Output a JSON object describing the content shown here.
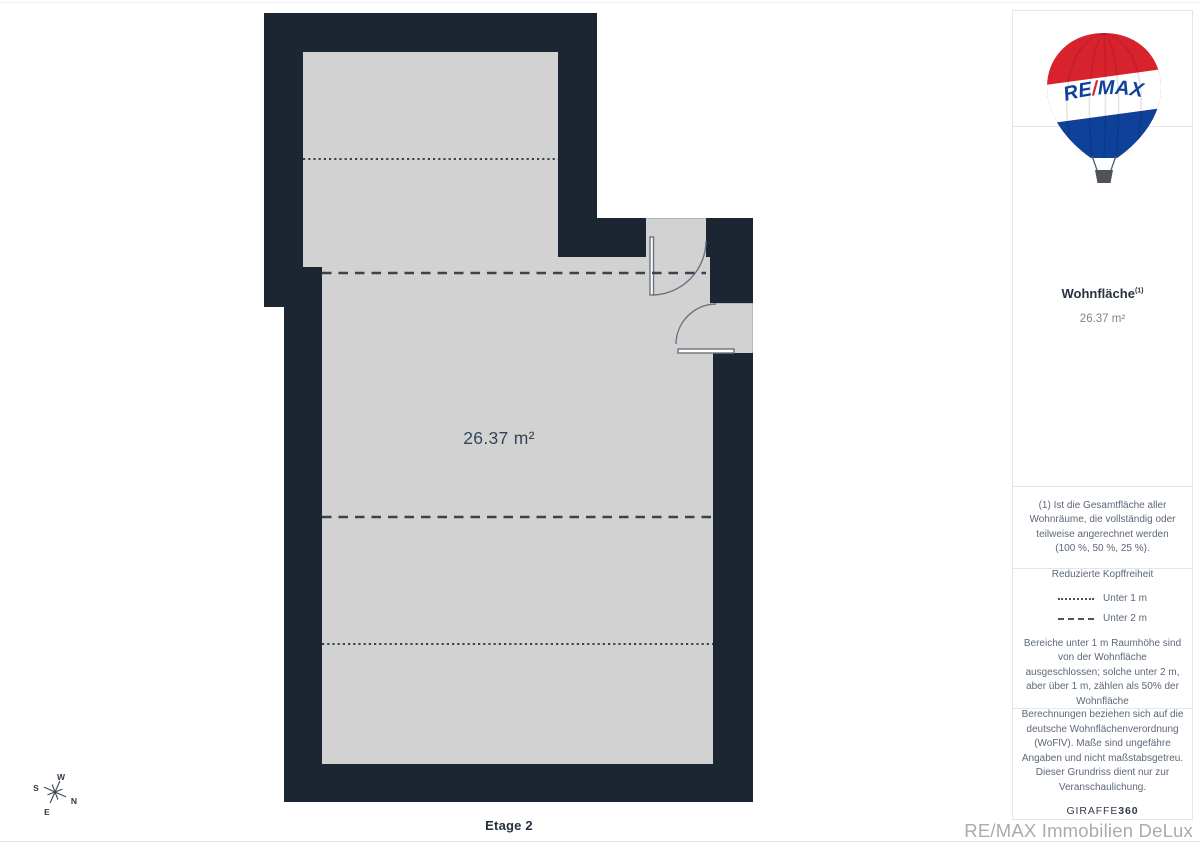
{
  "plan": {
    "area_label": "26.37 m²",
    "floor_label": "Etage 2",
    "compass": {
      "n": "N",
      "e": "E",
      "s": "S",
      "w": "W"
    }
  },
  "sidebar": {
    "balloon": {
      "re": "RE",
      "slash": "/",
      "max": "MAX"
    },
    "area": {
      "label": "Wohnfläche",
      "marker": "(1)",
      "value": "26.37 m²"
    },
    "footnote": "(1) Ist die Gesamtfläche aller Wohnräume, die vollständig oder teilweise angerechnet werden (100 %, 50 %, 25 %).",
    "legend": {
      "title": "Reduzierte Kopffreiheit",
      "items": [
        {
          "label": "Unter 1 m"
        },
        {
          "label": "Unter 2 m"
        }
      ],
      "note": "Bereiche unter 1 m Raumhöhe sind von der Wohnfläche ausgeschlossen; solche unter 2 m, aber über 1 m, zählen als 50% der Wohnfläche"
    },
    "disclaimer": "Berechnungen beziehen sich auf die deutsche Wohnflächenverordnung (WoFlV). Maße sind ungefähre Angaben und nicht maßstabsgetreu. Dieser Grundriss dient nur zur Veranschaulichung.",
    "giraffe": {
      "brand": "GIRAFFE",
      "suffix": "360"
    }
  },
  "footer": {
    "watermark": "RE/MAX Immobilien DeLux"
  },
  "colors": {
    "wall": "#1c2632",
    "floor": "#d2d2d3",
    "dash": "#39434e",
    "door": "#6a7380",
    "label": "#34465a",
    "compass": "#3b4754",
    "remax_red": "#d8232f",
    "remax_blue": "#0e4199"
  }
}
